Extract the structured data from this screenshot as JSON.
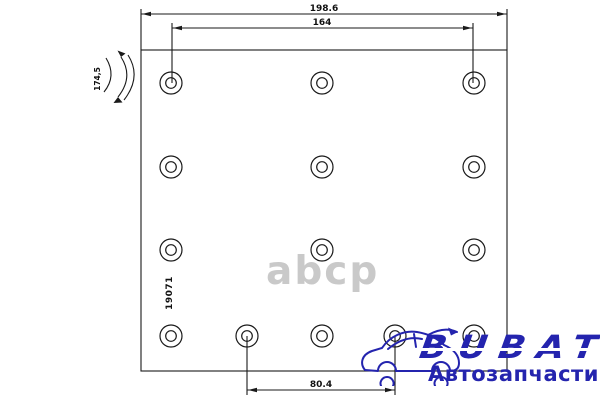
{
  "canvas": {
    "background": "#ffffff",
    "line_color": "#1a1a1a"
  },
  "drawing": {
    "type": "brake-lining-technical-drawing",
    "marking": "19071",
    "dims": {
      "overall_width": "198.6",
      "top_hole_span": "164",
      "bottom_hole_span": "80.4",
      "arc_radius": "174,5"
    },
    "geometry": {
      "rect": {
        "x": 141,
        "y": 50,
        "w": 366,
        "h": 321
      },
      "hole_outer_r": 11,
      "hole_inner_r": 5.3,
      "holes": [
        [
          171,
          83
        ],
        [
          322,
          83
        ],
        [
          474,
          83
        ],
        [
          171,
          167
        ],
        [
          322,
          167
        ],
        [
          474,
          167
        ],
        [
          171,
          250
        ],
        [
          322,
          250
        ],
        [
          474,
          250
        ],
        [
          171,
          336
        ],
        [
          247,
          336
        ],
        [
          322,
          336
        ],
        [
          395,
          336
        ],
        [
          474,
          336
        ]
      ]
    }
  },
  "watermark": {
    "text": "abcp",
    "color": "#c9c9c9"
  },
  "logo": {
    "brand": "BUBAT",
    "subtitle": "Автозапчасти",
    "color": "#2424ae",
    "icon": "car-icon"
  }
}
